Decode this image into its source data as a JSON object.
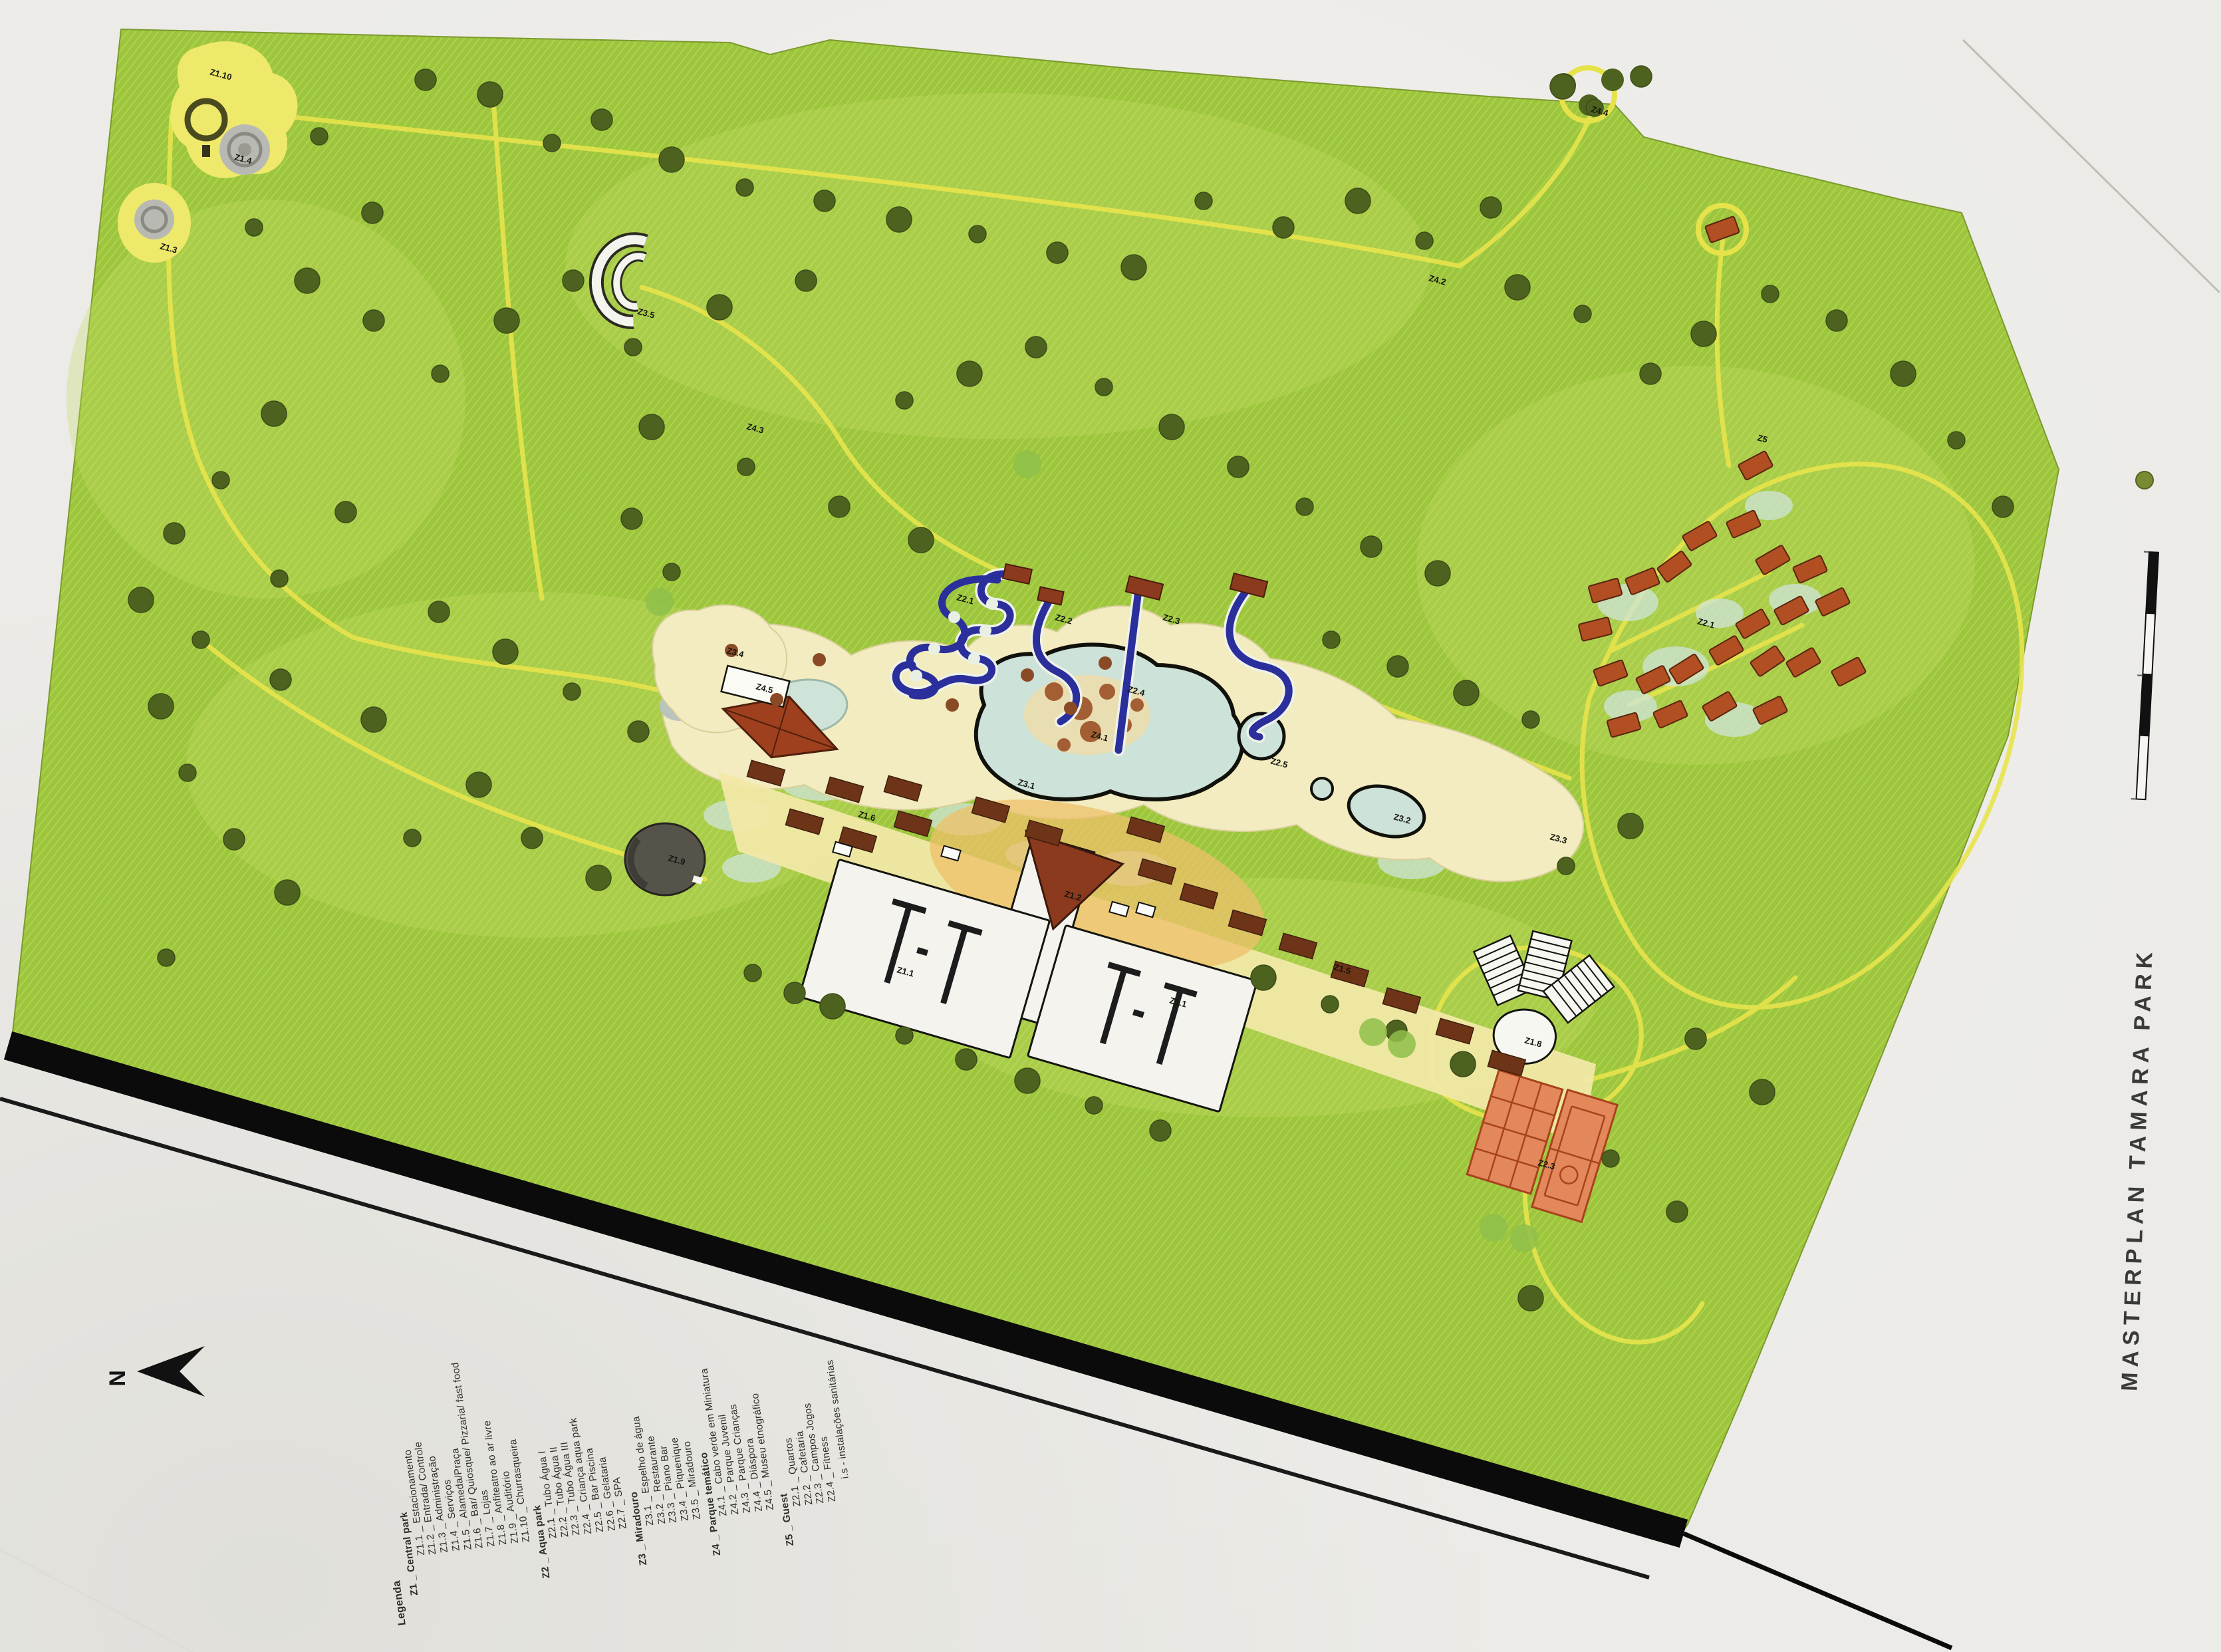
{
  "title": "MASTERPLAN TAMARA PARK",
  "compass": {
    "label": "N"
  },
  "legend": {
    "heading": "Legenda",
    "footnote": "i.s - instalações sanitárias",
    "groups": [
      {
        "label": "Z1 _ Central park",
        "items": [
          "Z1.1 _ Estacionamento",
          "Z1.2 _ Entrada/ Controle",
          "Z1.3 _ Administração",
          "Z1.4 _ Serviços",
          "Z1.5 _ Alameda/Praça",
          "Z1.6 _ Bar/ Quiosque/ Pizzaria/ fast food",
          "Z1.7 _ Lojas",
          "Z1.8 _ Anfiteatro ao ar livre",
          "Z1.9 _ Auditório",
          "Z1.10 _ Churrasqueira"
        ]
      },
      {
        "label": "Z2 _ Aqua park",
        "items": [
          "Z2.1 _ Tubo Água I",
          "Z2.2 _ Tubo Água II",
          "Z2.3 _ Tubo Água III",
          "Z2.4 _ Criança aqua park",
          "Z2.5 _ Bar Piscina",
          "Z2.6 _ Gelataria",
          "Z2.7 _ SPA"
        ]
      },
      {
        "label": "Z3 _ Miradouro",
        "items": [
          "Z3.1 _ Espelho de água",
          "Z3.2 _ Restaurante",
          "Z3.3 _ Piano Bar",
          "Z3.4 _ Piquenique",
          "Z3.5 _ Miradouro"
        ]
      },
      {
        "label": "Z4 _ Parque temático",
        "items": [
          "Z4.1 _ Cabo verde em Miniatura",
          "Z4.2 _ Parque Juvenil",
          "Z4.3 _ Parque Crianças",
          "Z4.4 _ Diáspora",
          "Z4.5 _ Museu etnográfico"
        ]
      },
      {
        "label": "Z5 _ Guest",
        "items": [
          "Z2.1 _ Quartos",
          "Z2.2 _ Cafetaria",
          "Z2.3 _ Campos Jogos",
          "Z2.4 _ Fitness"
        ]
      }
    ]
  },
  "map": {
    "colors": {
      "green": "#9dc53e",
      "green_hatch": "#aed44d",
      "tree": "#4e6220",
      "tree_light": "#8fbf4a",
      "path_yellow": "#e7e44c",
      "road_black": "#0b0b0b",
      "sand": "#f3ecc0",
      "pool": "#cde2d8",
      "building_red": "#b14f22",
      "kiosk_brown": "#6e3418",
      "entrance_red": "#8c3a1e",
      "slide_blue": "#2b2f9b",
      "seafoam": "#cfe4da",
      "court_orange": "#e2885a",
      "court_line": "#a8431d",
      "paper": "#ecebe7",
      "label_ink": "#15150e"
    },
    "zone_labels": [
      [
        315,
        112,
        "Z1.10"
      ],
      [
        352,
        240,
        "Z1.4"
      ],
      [
        240,
        374,
        "Z1.3"
      ],
      [
        958,
        472,
        "Z3.5"
      ],
      [
        1136,
        1036,
        "Z4.5"
      ],
      [
        1004,
        1294,
        "Z1.9"
      ],
      [
        1092,
        982,
        "Z3.4"
      ],
      [
        1438,
        902,
        "Z2.1"
      ],
      [
        1586,
        932,
        "Z2.2"
      ],
      [
        1748,
        932,
        "Z2.3"
      ],
      [
        1640,
        1108,
        "Z4.1"
      ],
      [
        1530,
        1180,
        "Z3.1"
      ],
      [
        1910,
        1148,
        "Z2.5"
      ],
      [
        2095,
        1232,
        "Z3.2"
      ],
      [
        2330,
        1262,
        "Z3.3"
      ],
      [
        1348,
        1462,
        "Z1.1"
      ],
      [
        1758,
        1508,
        "Z1.1"
      ],
      [
        1600,
        1348,
        "Z1.2"
      ],
      [
        1290,
        1228,
        "Z1.6"
      ],
      [
        2005,
        1458,
        "Z1.5"
      ],
      [
        2292,
        1568,
        "Z1.8"
      ],
      [
        2312,
        1752,
        "Z2.3"
      ],
      [
        2552,
        938,
        "Z2.1"
      ],
      [
        2642,
        662,
        "Z5"
      ],
      [
        1695,
        1040,
        "Z2.4"
      ],
      [
        2148,
        422,
        "Z4.2"
      ],
      [
        1122,
        645,
        "Z4.3"
      ],
      [
        2392,
        168,
        "Z4.4"
      ]
    ],
    "trees": [
      [
        480,
        205
      ],
      [
        640,
        120
      ],
      [
        737,
        142
      ],
      [
        830,
        215
      ],
      [
        905,
        180
      ],
      [
        1010,
        240
      ],
      [
        1120,
        282
      ],
      [
        1240,
        302
      ],
      [
        1352,
        330
      ],
      [
        1470,
        352
      ],
      [
        1590,
        380
      ],
      [
        1705,
        402
      ],
      [
        1810,
        302
      ],
      [
        1930,
        342
      ],
      [
        2042,
        302
      ],
      [
        2142,
        362
      ],
      [
        2242,
        312
      ],
      [
        2350,
        130
      ],
      [
        2398,
        162
      ],
      [
        2468,
        115
      ],
      [
        2282,
        432
      ],
      [
        2380,
        472
      ],
      [
        1212,
        422
      ],
      [
        1082,
        462
      ],
      [
        952,
        522
      ],
      [
        862,
        422
      ],
      [
        762,
        482
      ],
      [
        662,
        562
      ],
      [
        562,
        482
      ],
      [
        462,
        422
      ],
      [
        382,
        342
      ],
      [
        560,
        320
      ],
      [
        412,
        622
      ],
      [
        332,
        722
      ],
      [
        262,
        802
      ],
      [
        212,
        902
      ],
      [
        302,
        962
      ],
      [
        422,
        1022
      ],
      [
        562,
        1082
      ],
      [
        420,
        870
      ],
      [
        520,
        770
      ],
      [
        980,
        642
      ],
      [
        1122,
        702
      ],
      [
        1262,
        762
      ],
      [
        1385,
        812
      ],
      [
        2002,
        962
      ],
      [
        2102,
        1002
      ],
      [
        2205,
        1042
      ],
      [
        2302,
        1082
      ],
      [
        2062,
        822
      ],
      [
        2162,
        862
      ],
      [
        1962,
        762
      ],
      [
        1862,
        702
      ],
      [
        1762,
        642
      ],
      [
        1660,
        582
      ],
      [
        1558,
        522
      ],
      [
        1458,
        562
      ],
      [
        1360,
        602
      ],
      [
        2482,
        562
      ],
      [
        2562,
        502
      ],
      [
        2662,
        442
      ],
      [
        2762,
        482
      ],
      [
        2862,
        562
      ],
      [
        2942,
        662
      ],
      [
        3012,
        762
      ],
      [
        2452,
        1242
      ],
      [
        2355,
        1302
      ],
      [
        2550,
        1562
      ],
      [
        2650,
        1642
      ],
      [
        2422,
        1742
      ],
      [
        2522,
        1822
      ],
      [
        2302,
        1952
      ],
      [
        1132,
        1463
      ],
      [
        1195,
        1493
      ],
      [
        1252,
        1513
      ],
      [
        1360,
        1557
      ],
      [
        1453,
        1593
      ],
      [
        1545,
        1625
      ],
      [
        1645,
        1662
      ],
      [
        1745,
        1700
      ],
      [
        242,
        1062
      ],
      [
        282,
        1162
      ],
      [
        352,
        1262
      ],
      [
        432,
        1342
      ],
      [
        250,
        1440
      ],
      [
        660,
        920
      ],
      [
        760,
        980
      ],
      [
        860,
        1040
      ],
      [
        960,
        1100
      ],
      [
        720,
        1180
      ],
      [
        620,
        1260
      ],
      [
        800,
        1260
      ],
      [
        900,
        1320
      ],
      [
        1010,
        860
      ],
      [
        950,
        780
      ],
      [
        1900,
        1470
      ],
      [
        2000,
        1510
      ],
      [
        2100,
        1550
      ],
      [
        2200,
        1600
      ]
    ],
    "light_trees": [
      [
        2065,
        1552
      ],
      [
        2108,
        1570
      ],
      [
        2246,
        1846
      ],
      [
        2292,
        1862
      ],
      [
        1545,
        698
      ],
      [
        992,
        905
      ]
    ],
    "bungalows": [
      [
        2590,
        345,
        -20
      ],
      [
        2640,
        700,
        -28
      ],
      [
        2622,
        788,
        -24
      ],
      [
        2556,
        806,
        -30
      ],
      [
        2518,
        852,
        -36
      ],
      [
        2470,
        874,
        -22
      ],
      [
        2414,
        888,
        -16
      ],
      [
        2399,
        946,
        -14
      ],
      [
        2422,
        1012,
        -20
      ],
      [
        2486,
        1022,
        -26
      ],
      [
        2536,
        1006,
        -32
      ],
      [
        2442,
        1090,
        -16
      ],
      [
        2512,
        1074,
        -24
      ],
      [
        2586,
        1062,
        -30
      ],
      [
        2658,
        994,
        -34
      ],
      [
        2636,
        938,
        -30
      ],
      [
        2596,
        978,
        -30
      ],
      [
        2666,
        842,
        -30
      ],
      [
        2722,
        856,
        -24
      ],
      [
        2694,
        918,
        -28
      ],
      [
        2712,
        996,
        -30
      ],
      [
        2662,
        1068,
        -26
      ],
      [
        2756,
        905,
        -26
      ],
      [
        2780,
        1010,
        -28
      ]
    ],
    "kiosks": [
      [
        1152,
        1162
      ],
      [
        1270,
        1187
      ],
      [
        1358,
        1185
      ],
      [
        1373,
        1238
      ],
      [
        1490,
        1217
      ],
      [
        1570,
        1252
      ],
      [
        1723,
        1247
      ],
      [
        1740,
        1310
      ],
      [
        1803,
        1347
      ],
      [
        1876,
        1387
      ],
      [
        1952,
        1422
      ],
      [
        2030,
        1464
      ],
      [
        2108,
        1504
      ],
      [
        2188,
        1550
      ],
      [
        2266,
        1598
      ],
      [
        1210,
        1235
      ],
      [
        1290,
        1262
      ]
    ],
    "seafoam": [
      [
        2448,
        906,
        46,
        28
      ],
      [
        2520,
        1002,
        50,
        30
      ],
      [
        2608,
        1082,
        44,
        26
      ],
      [
        2452,
        1062,
        40,
        24
      ],
      [
        2700,
        902,
        40,
        24
      ],
      [
        2586,
        922,
        36,
        22
      ],
      [
        1235,
        1178,
        60,
        26
      ],
      [
        1108,
        1226,
        50,
        24
      ],
      [
        1958,
        1182,
        46,
        22
      ],
      [
        2124,
        1296,
        52,
        26
      ],
      [
        1452,
        1232,
        56,
        24
      ],
      [
        1698,
        1306,
        60,
        26
      ],
      [
        2660,
        760,
        36,
        22
      ],
      [
        1560,
        1285,
        48,
        22
      ],
      [
        1130,
        1305,
        44,
        22
      ]
    ],
    "sand_dots": [
      [
        1100,
        978
      ],
      [
        1168,
        1052
      ],
      [
        1232,
        992
      ],
      [
        1545,
        1015
      ],
      [
        1610,
        1065
      ],
      [
        1662,
        997
      ],
      [
        1432,
        1060
      ]
    ],
    "is_marks": [
      [
        1430,
        1283
      ],
      [
        1683,
        1367
      ],
      [
        1723,
        1368
      ],
      [
        1267,
        1277
      ]
    ]
  }
}
